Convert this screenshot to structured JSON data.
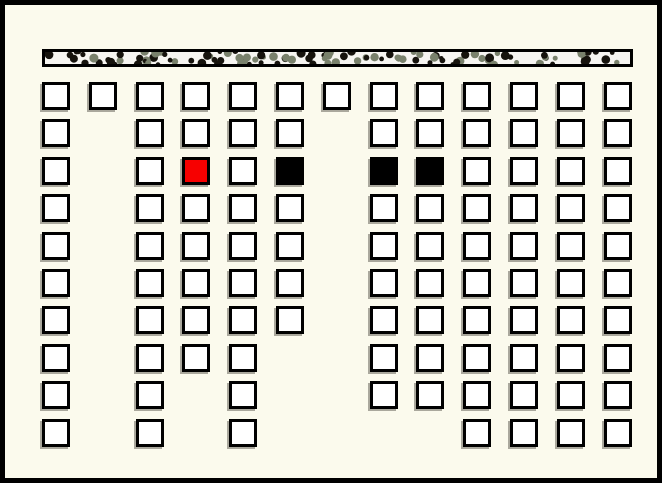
{
  "window": {
    "kind": "game-board-screen",
    "has_text": false
  },
  "colors": {
    "background": "#fbfaed",
    "frame_border": "#000000",
    "cell_border": "#000000",
    "cell_fill_white": "#ffffff",
    "cell_fill_red": "#f70000",
    "cell_fill_black": "#000000",
    "cell_shadow": "#aaa89d",
    "bar_fill": "#f6f5f1",
    "bar_border": "#000000",
    "bar_dot_dark": "#16130d",
    "bar_dot_olive": "#79816c"
  },
  "board": {
    "columns": 13,
    "rows": 10,
    "legend": {
      "w": "white-cell",
      "r": "red-cell",
      "b": "black-cell",
      ".": "empty"
    },
    "matrix": [
      "wwwwwwwwwwwww",
      "w.wwww.wwwwww",
      "w.wrwb.bbwwww",
      "w.wwww.wwwwww",
      "w.wwww.wwwwww",
      "w.wwww.wwwwww",
      "w.wwww.wwwwww",
      "w.www..wwwwww",
      "w.w.w..wwwwww",
      "w.w.w....wwww"
    ],
    "cell_counts": {
      "total": 105,
      "white": 101,
      "red": 1,
      "black": 3
    },
    "highlight_cells": [
      {
        "row": 2,
        "col": 3,
        "state": "red"
      },
      {
        "row": 2,
        "col": 5,
        "state": "black"
      },
      {
        "row": 2,
        "col": 7,
        "state": "black"
      },
      {
        "row": 2,
        "col": 8,
        "state": "black"
      }
    ]
  }
}
